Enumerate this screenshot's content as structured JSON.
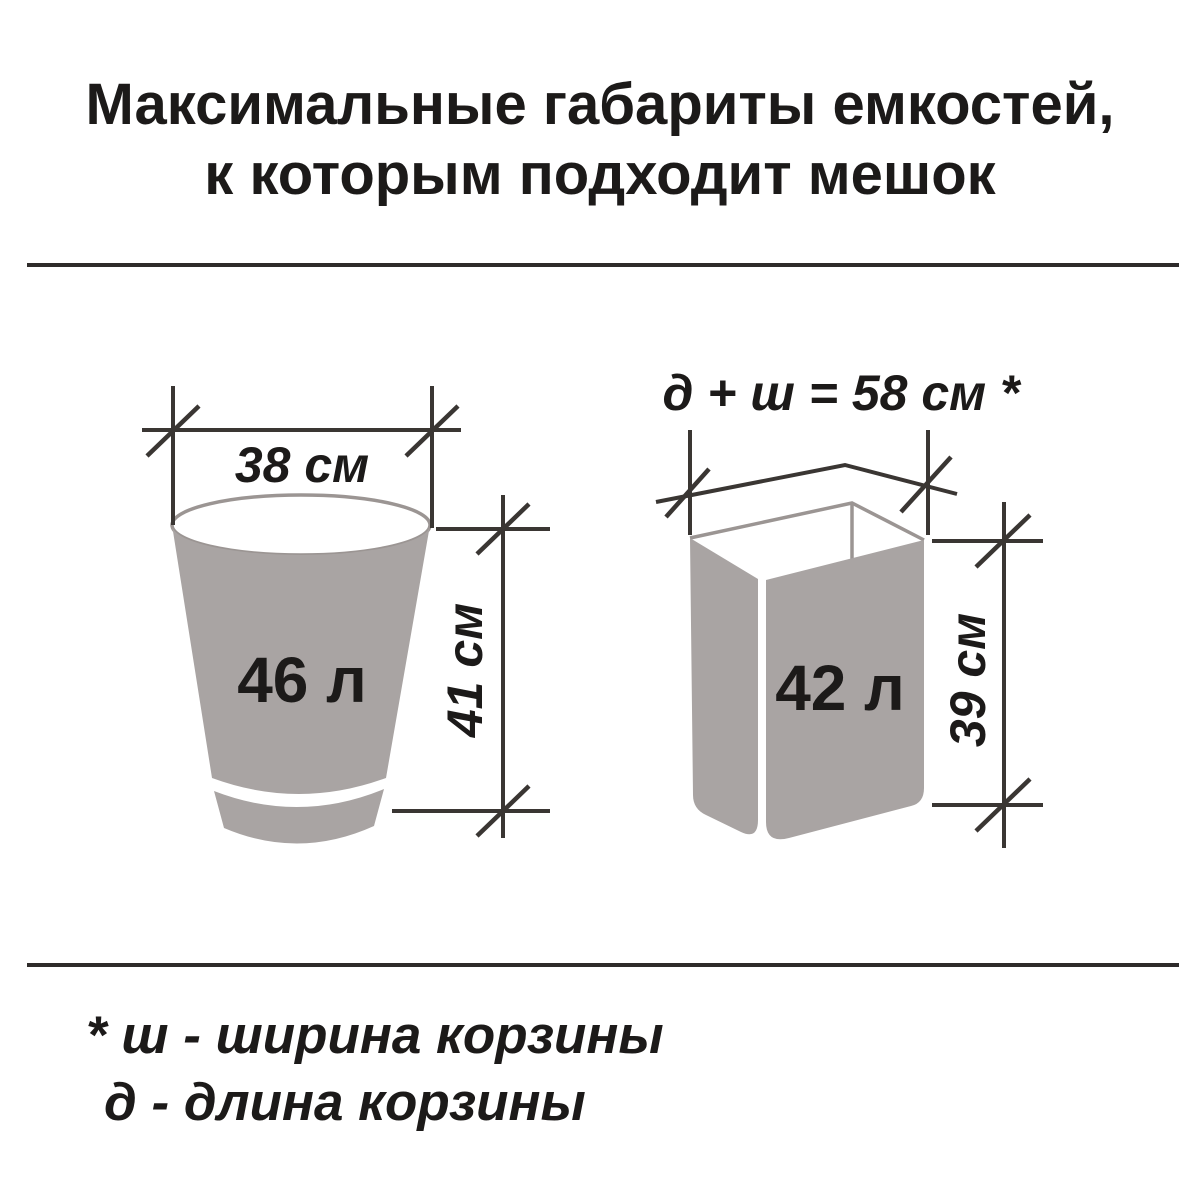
{
  "title": {
    "line1": "Максимальные габариты емкостей,",
    "line2": "к которым подходит мешок"
  },
  "left_container": {
    "volume": "46 л",
    "width": "38 см",
    "height": "41 см"
  },
  "right_container": {
    "volume": "42 л",
    "top_dimension": "д + ш = 58 см *",
    "height": "39 см"
  },
  "footnote": {
    "line1": "* ш - ширина корзины",
    "line2": "д - длина корзины"
  },
  "colors": {
    "background": "#ffffff",
    "container_fill": "#a9a4a3",
    "container_outline": "#9b9593",
    "dimension_line": "#3a3633",
    "text": "#1c1a19"
  }
}
